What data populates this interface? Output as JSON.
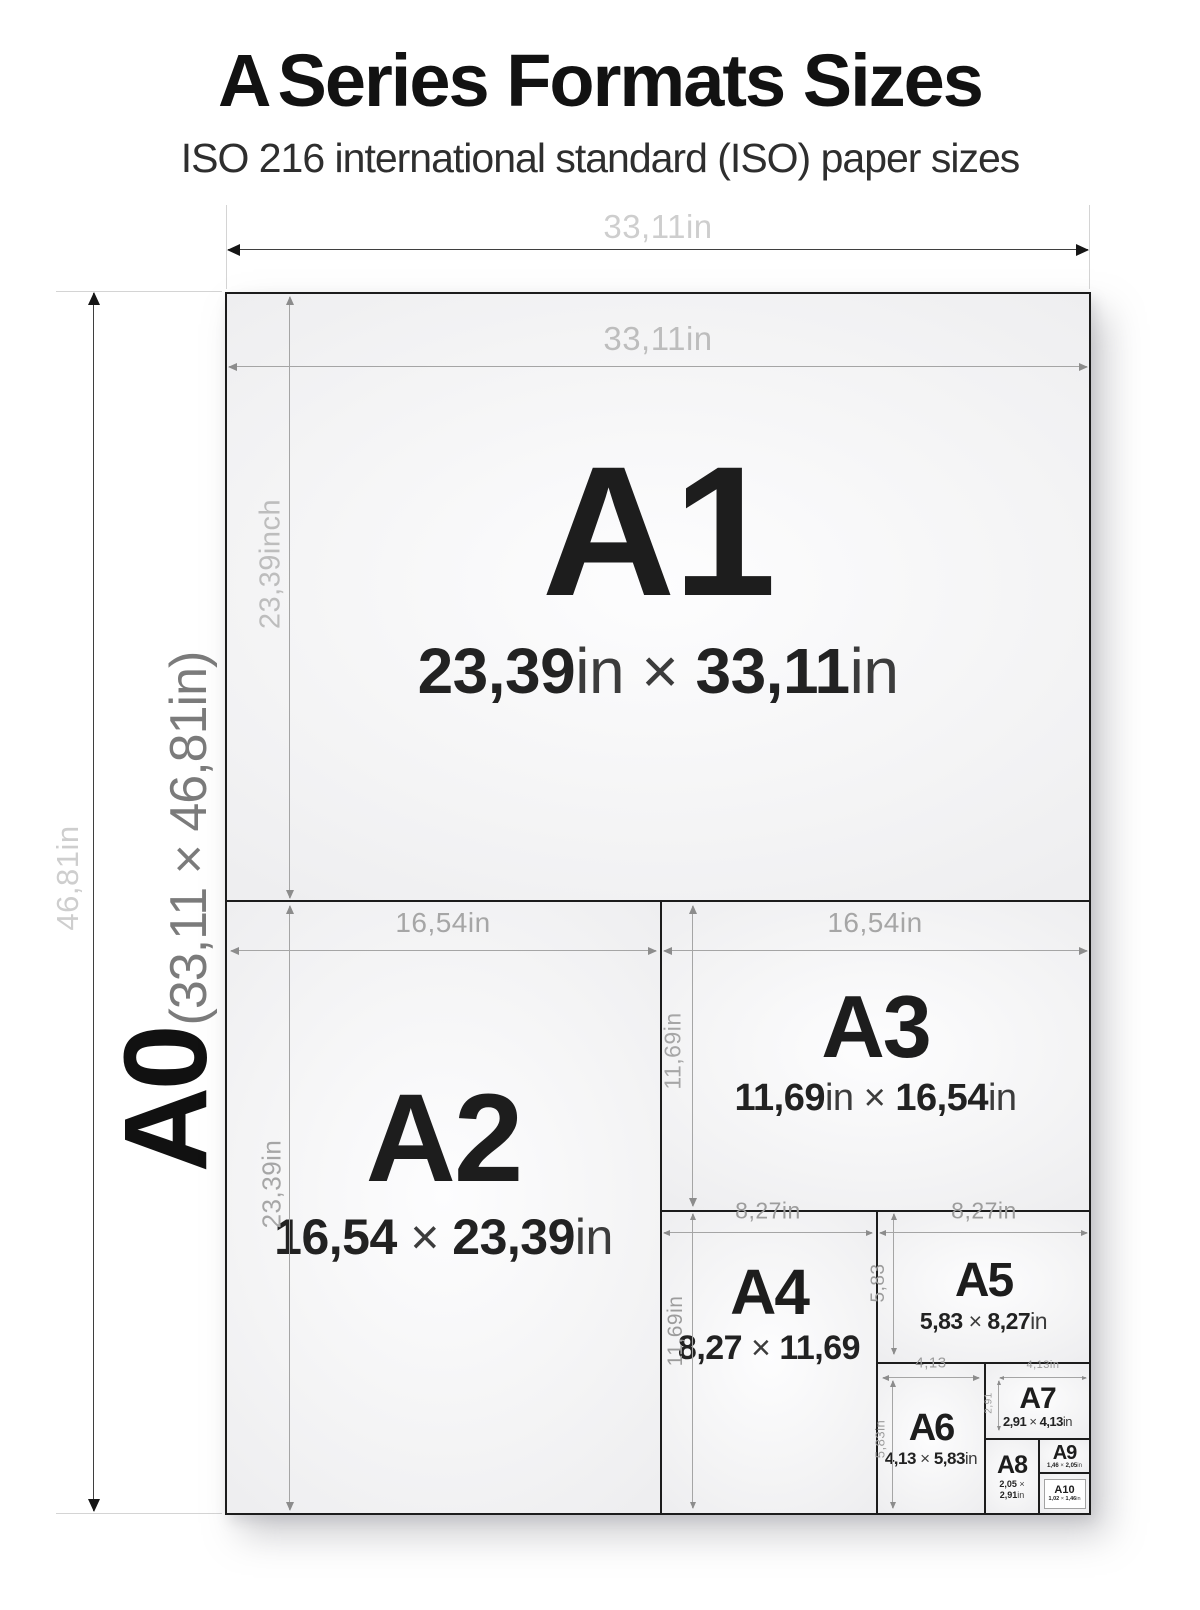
{
  "title": {
    "prefix": "A",
    "rest": "Series Formats Sizes"
  },
  "subtitle": "ISO 216 international standard (ISO) paper sizes",
  "a0": {
    "label": "A0",
    "size": "(33,11 × 46,81in)",
    "width_dim": "33,11in",
    "height_dim": "46,81in"
  },
  "cells": {
    "a1": {
      "label": "A1",
      "size": "23,39in × 33,11in",
      "width_dim": "33,11in",
      "height_dim": "23,39inch"
    },
    "a2": {
      "label": "A2",
      "size": "16,54 × 23,39in",
      "width_dim": "16,54in",
      "height_dim": "23,39in"
    },
    "a3": {
      "label": "A3",
      "size": "11,69in × 16,54in",
      "width_dim": "16,54in",
      "height_dim": "11,69in"
    },
    "a4": {
      "label": "A4",
      "size": "8,27 × 11,69",
      "width_dim": "8,27in",
      "height_dim": "11,69in"
    },
    "a5": {
      "label": "A5",
      "size": "5,83 × 8,27in",
      "width_dim": "8,27in",
      "height_dim": "5,83"
    },
    "a6": {
      "label": "A6",
      "size": "4,13 × 5,83in",
      "width_dim": "4,13",
      "height_dim": "5,83in"
    },
    "a7": {
      "label": "A7",
      "size": "2,91 × 4,13in",
      "width_dim": "4,13in",
      "height_dim": "2,91"
    },
    "a8": {
      "label": "A8",
      "size": "2,05 × 2,91in"
    },
    "a9": {
      "label": "A9",
      "size": "1,46 × 2,05in"
    },
    "a10": {
      "label": "A10",
      "size": "1,02 × 1,46in"
    }
  },
  "colors": {
    "paper_border": "#1c1c1c",
    "paper_fill": "#f1f1f2",
    "dim_line": "#a5a5a5",
    "dim_label_light": "#cecece",
    "dim_label_mid": "#a6a6a6",
    "text_dark": "#1d1d1d"
  }
}
